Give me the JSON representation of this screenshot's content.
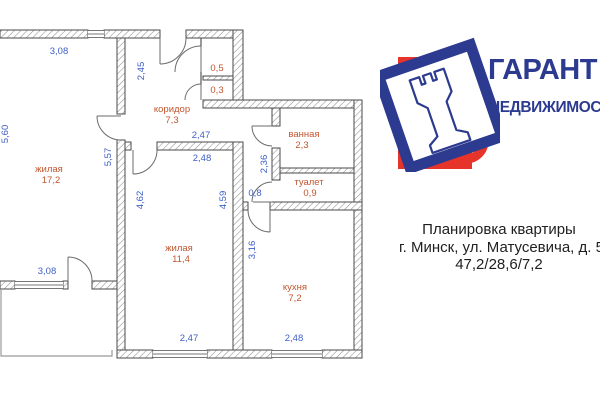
{
  "plan": {
    "rooms": [
      {
        "name": "жилая",
        "area": "17,2"
      },
      {
        "name": "коридор",
        "area": "7,3"
      },
      {
        "name": "ванная",
        "area": "2,3"
      },
      {
        "name": "туалет",
        "area": "0,9"
      },
      {
        "name": "жилая",
        "area": "11,4"
      },
      {
        "name": "кухня",
        "area": "7,2"
      },
      {
        "area": "0,5"
      },
      {
        "area": "0,3"
      }
    ],
    "dims": [
      "3,08",
      "5,60",
      "2,45",
      "5,57",
      "2,47",
      "2,48",
      "4,62",
      "4,59",
      "2,36",
      "0,8",
      "3,16",
      "3,08",
      "2,47",
      "2,48"
    ],
    "colors": {
      "room_label": "#c2562f",
      "dimension_label": "#3d5ec6",
      "wall_line": "#4a4a4a"
    }
  },
  "logo": {
    "name": "ГАРАНТ",
    "tagline": "НЕДВИЖИМОСТЬ",
    "colors": {
      "blue": "#2c3a8f",
      "red": "#e6342b"
    }
  },
  "caption": {
    "line1": "Планировка квартиры",
    "line2": "г. Минск, ул. Матусевича, д. 5",
    "line3": "47,2/28,6/7,2"
  }
}
